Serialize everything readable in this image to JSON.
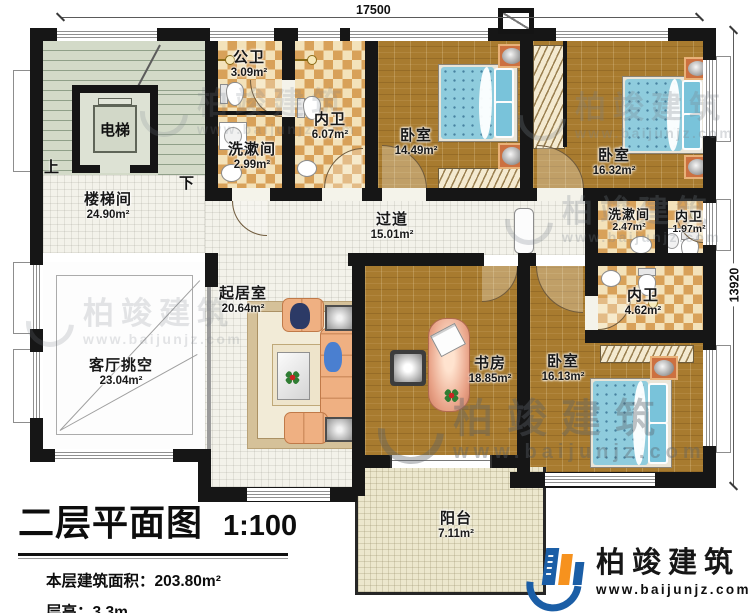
{
  "plan": {
    "dimensions": {
      "top": "17500",
      "right": "13920"
    },
    "rooms": {
      "gongwei": {
        "name": "公卫",
        "area": "3.09m²"
      },
      "xishujian_top": {
        "name": "洗漱间",
        "area": "2.99m²"
      },
      "neiwei_top": {
        "name": "内卫",
        "area": "6.07m²"
      },
      "bedroom1": {
        "name": "卧室",
        "area": "14.49m²"
      },
      "bedroom2": {
        "name": "卧室",
        "area": "16.32m²"
      },
      "elevator": {
        "name": "电梯"
      },
      "stairwell": {
        "name": "楼梯间",
        "area": "24.90m²"
      },
      "hallway": {
        "name": "过道",
        "area": "15.01m²"
      },
      "xishujian_right": {
        "name": "洗漱间",
        "area": "2.47m²"
      },
      "neiwei_small": {
        "name": "内卫",
        "area": "1.97m²"
      },
      "neiwei_mid": {
        "name": "内卫",
        "area": "4.62m²"
      },
      "living": {
        "name": "起居室",
        "area": "20.64m²"
      },
      "void": {
        "name": "客厅挑空",
        "area": "23.04m²"
      },
      "study": {
        "name": "书房",
        "area": "18.85m²"
      },
      "bedroom3": {
        "name": "卧室",
        "area": "16.13m²"
      },
      "balcony": {
        "name": "阳台",
        "area": "7.11m²"
      }
    },
    "stair_labels": {
      "up": "上",
      "down": "下"
    }
  },
  "title_block": {
    "title": "二层平面图",
    "scale": "1:100",
    "area_label": "本层建筑面积：",
    "area_value": "203.80m²",
    "height_label": "层高：",
    "height_value": "3.3m"
  },
  "branding": {
    "logo_name": "柏竣建筑",
    "logo_url": "www.baijunjz.com",
    "brand_blue": "#1b5ea6",
    "brand_orange": "#f6921e"
  },
  "watermark": {
    "name": "柏竣建筑",
    "url": "www.baijunjz.com"
  }
}
